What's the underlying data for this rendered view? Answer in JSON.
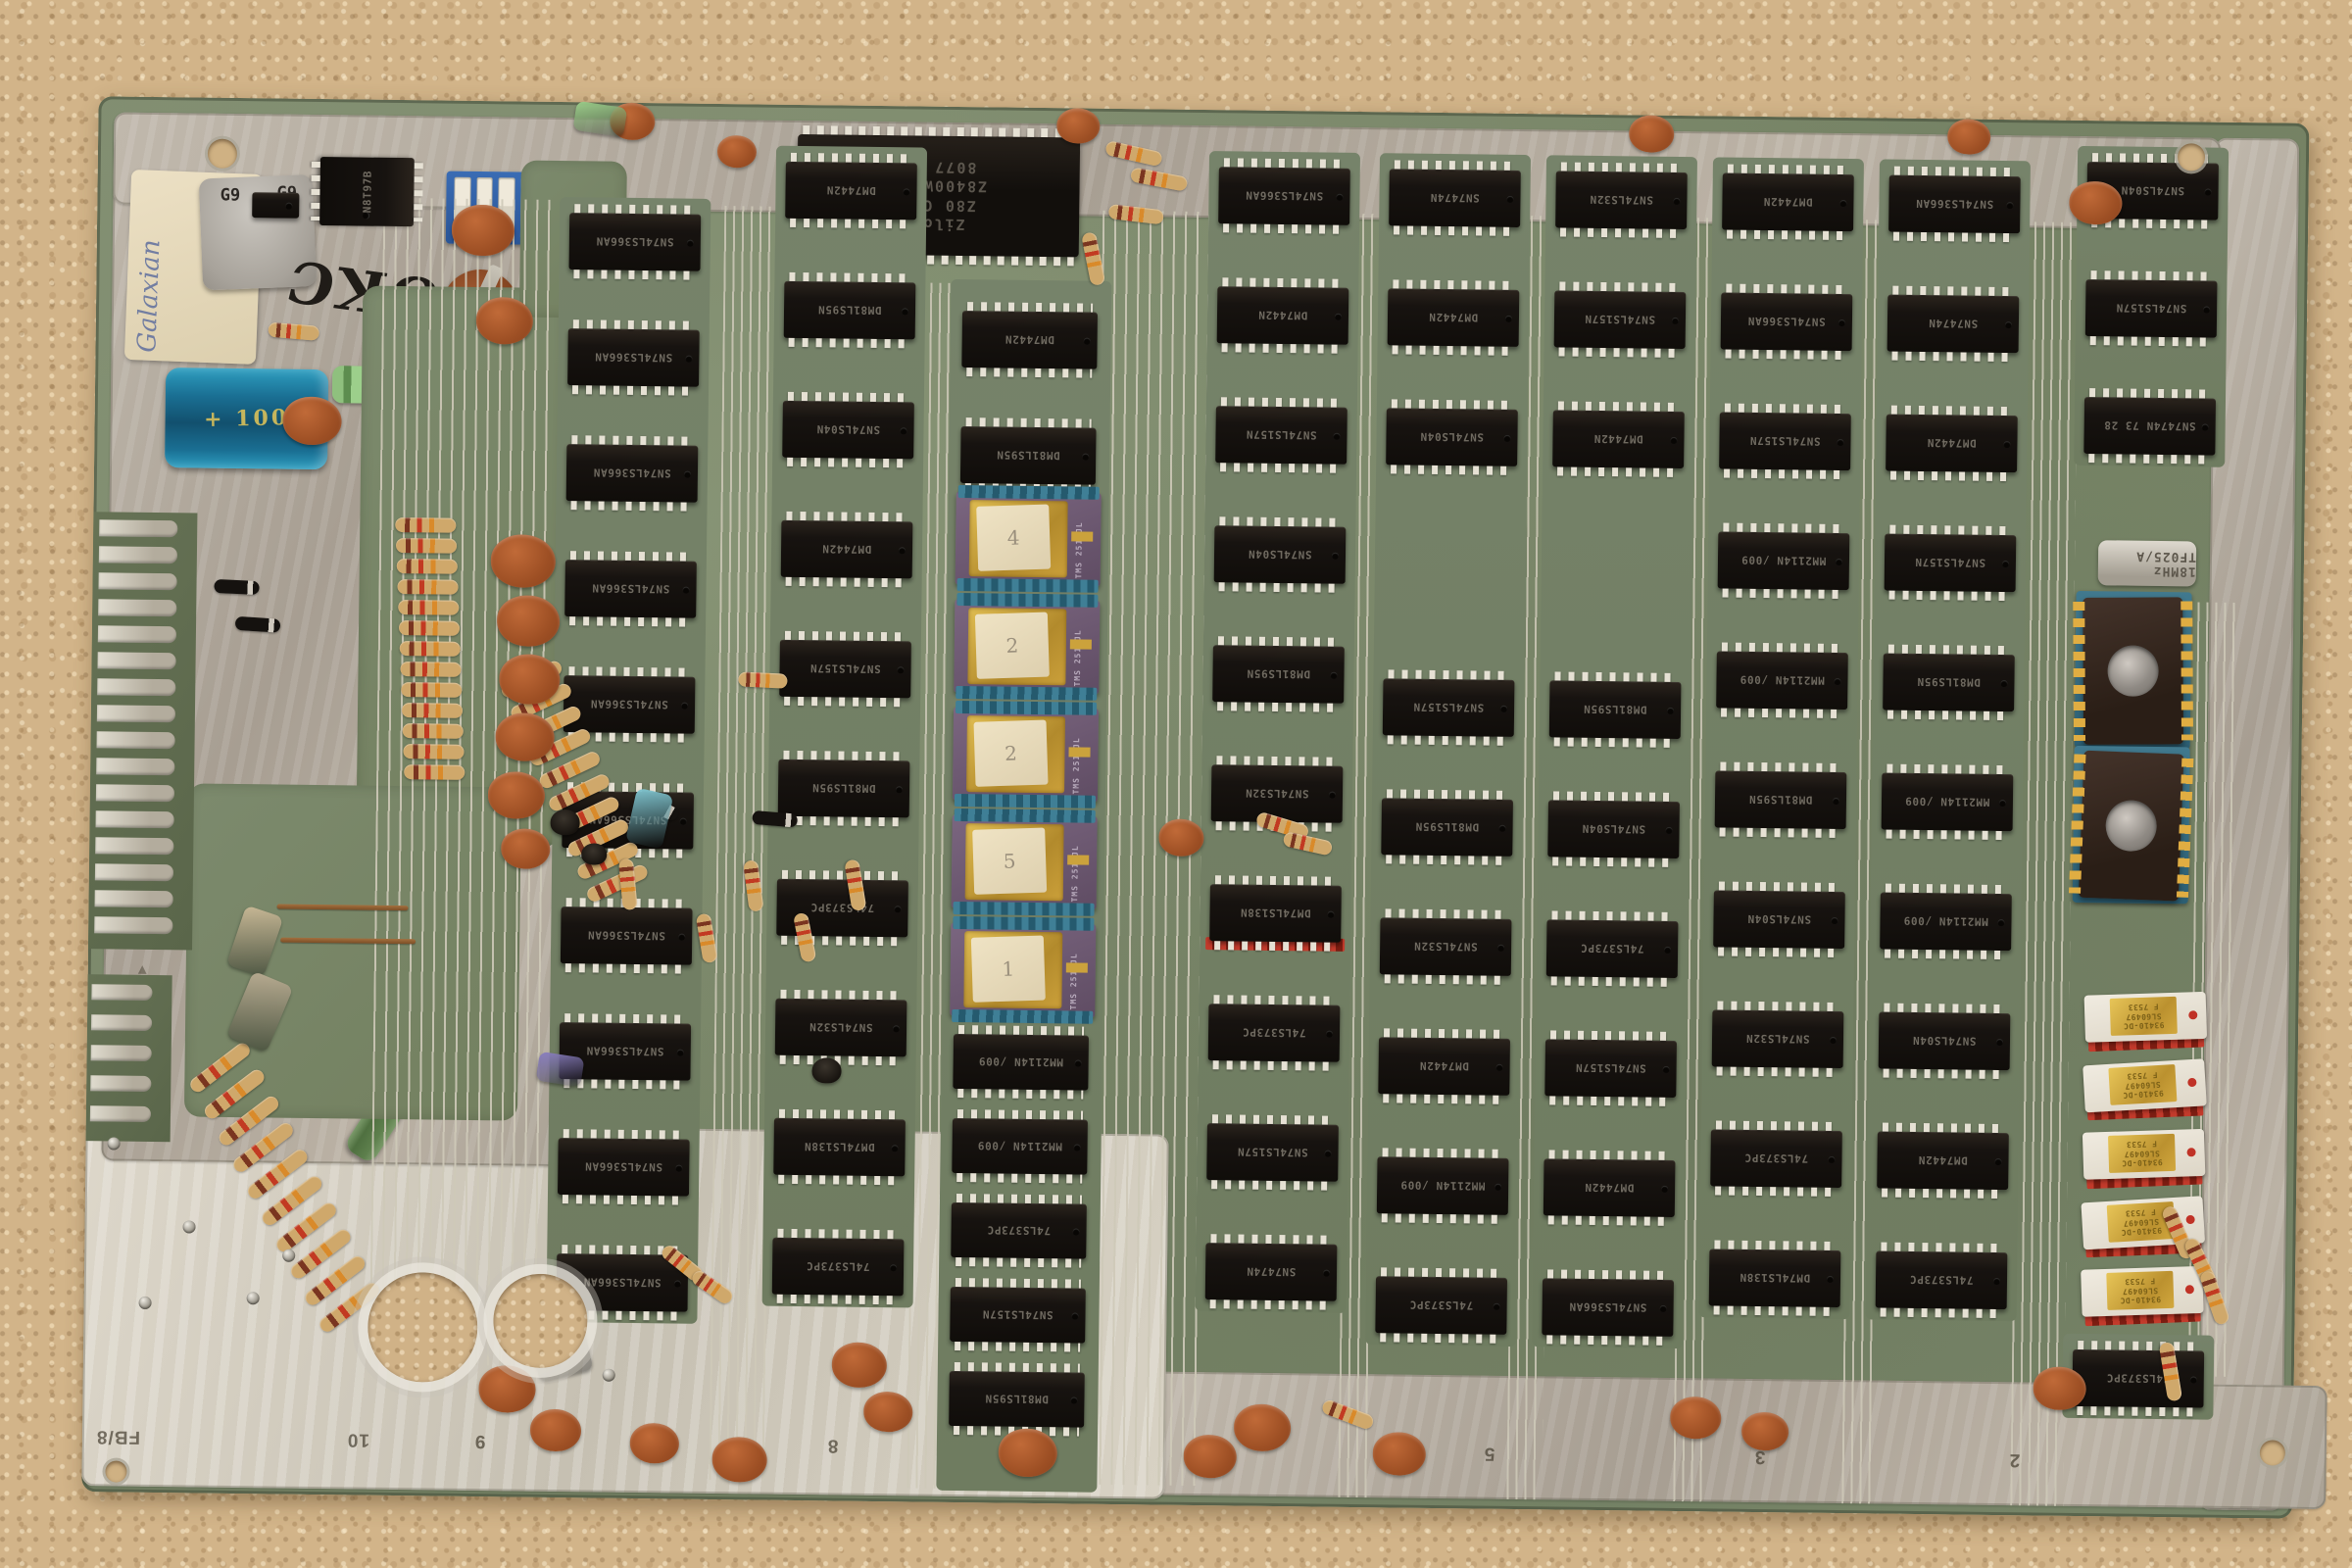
{
  "scene": {
    "description": "Vintage Z80 arcade printed circuit board lying on tan carpet",
    "carpet_color": "#d2b489",
    "board_green": "#78866a",
    "tinned_silver": "#b4aba0",
    "trace_silver": "#cdc8b8",
    "chip_black": "#171310",
    "eprom_purple": "#6c5870",
    "eprom_gold": "#c9a23a",
    "socket_blue": "#3a7389",
    "socket_red": "#a83226",
    "white_ceramic": "#ece6da",
    "orange_cap": "#a8552a",
    "resistor_tan": "#cfa86b"
  },
  "markings": {
    "handwritten_board_text": "OKC",
    "paper_label_text": "Galaxian",
    "grey_cap_text": "G9",
    "grey_cap_text2": "G9",
    "edge_letter": "N",
    "triangle_mark": "▲",
    "corner_stamp": "FB/8",
    "bottom_numbers": [
      "10",
      "9",
      "8",
      "5",
      "3",
      "2"
    ],
    "blue_cap_text": "+ 100",
    "dip_switch_numbers": [
      "1",
      "2",
      "3",
      "4",
      "5",
      "6"
    ]
  },
  "cpu": {
    "brand": "Zilog",
    "line1": "Z80 CPU",
    "line2": "Z8400W DD",
    "line3": "8077 PS"
  },
  "crystal": {
    "label": "18MHz TF025/A"
  },
  "eproms": {
    "part": "TMS 2516JL",
    "labels": [
      "4",
      "2",
      "2",
      "5",
      "1"
    ]
  },
  "white_ram": {
    "line1": "93410-DC",
    "line2": "SL60497",
    "line3": "F 7533",
    "count": 5
  },
  "sram": {
    "line1": "MWS5101AEL3",
    "line2": "RCA 010"
  },
  "rom_column": {
    "top": [
      "DM7442N",
      "DM81LS95N"
    ],
    "bottom": [
      "MM2114N /009",
      "MM2114N /009",
      "74LS373PC",
      "SN74LS157N",
      "DM81LS95N"
    ]
  },
  "ic_columns": [
    [
      "SN74LS366AN",
      "SN74LS366AN",
      "SN74LS366AN",
      "SN74LS366AN",
      "SN74LS366AN",
      "SN74LS366AN",
      "SN74LS366AN",
      "SN74LS366AN",
      "SN74LS366AN",
      "SN74LS366AN"
    ],
    [
      "DM7442N",
      "DM81LS95N",
      "SN74LS04N",
      "DM7442N",
      "SN74LS157N",
      "DM81LS95N",
      "74LS373PC",
      "SN74LS32N",
      "DM74LS138N",
      "74LS373PC"
    ],
    [
      "SN74LS366AN",
      "DM7442N",
      "SN74LS157N",
      "SN74LS04N",
      "DM81LS95N",
      "SN74LS32N",
      "DM74LS138N",
      "74LS373PC",
      "SN74LS157N",
      "SN7474N"
    ],
    [
      "SN7474N",
      "DM7442N",
      "SN74LS04N",
      "SN74LS157N",
      "DM81LS95N",
      "SN74LS32N",
      "DM7442N",
      "MM2114N /009",
      "74LS373PC"
    ],
    [
      "SN74LS32N",
      "SN74LS157N",
      "DM7442N",
      "DM81LS95N",
      "SN74LS04N",
      "74LS373PC",
      "SN74LS157N",
      "DM7442N",
      "SN74LS366AN"
    ],
    [
      "DM7442N",
      "SN74LS366AN",
      "SN74LS157N",
      "MM2114N /009",
      "MM2114N /009",
      "DM81LS95N",
      "SN74LS04N",
      "SN74LS32N",
      "74LS373PC",
      "DM74LS138N"
    ],
    [
      "SN74LS366AN",
      "SN7474N",
      "DM7442N",
      "SN74LS157N",
      "DM81LS95N",
      "MM2114N /009",
      "MM2114N /009",
      "SN74LS04N",
      "DM7442N",
      "74LS373PC"
    ],
    [
      "SN74LS04N",
      "SN74LS157N",
      "SN7474N 73 28"
    ],
    [
      "74LS373PC"
    ]
  ]
}
